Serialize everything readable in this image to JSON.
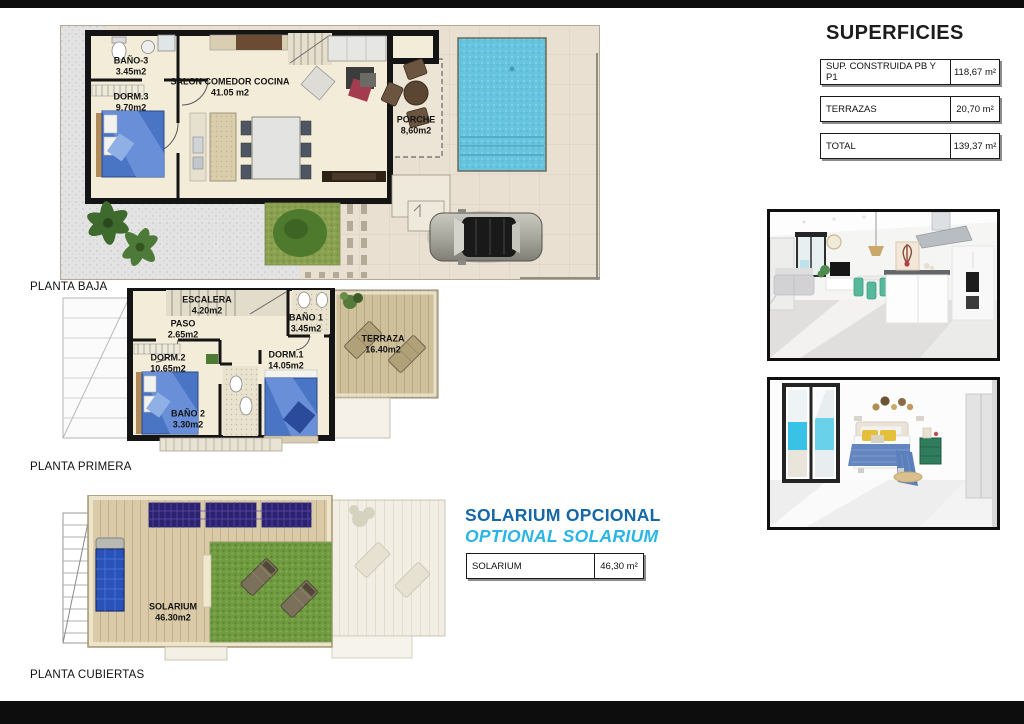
{
  "page": {
    "background": "#ffffff",
    "border_bar_color": "#0d0d0d"
  },
  "superficies": {
    "title": "SUPERFICIES",
    "rows": [
      {
        "label": "SUP. CONSTRUIDA PB Y P1",
        "value": "118,67 m²"
      },
      {
        "label": "TERRAZAS",
        "value": "20,70 m²"
      },
      {
        "label": "TOTAL",
        "value": "139,37 m²"
      }
    ]
  },
  "plans": {
    "baja": {
      "label": "PLANTA BAJA",
      "rooms": {
        "bano3": {
          "name": "BAÑO-3",
          "area": "3.45m2"
        },
        "dorm3": {
          "name": "DORM.3",
          "area": "9.70m2"
        },
        "salon": {
          "name": "SALON COMEDOR COCINA",
          "area": "41.05 m2"
        },
        "porche": {
          "name": "PORCHE",
          "area": "8,60m2"
        }
      }
    },
    "primera": {
      "label": "PLANTA PRIMERA",
      "rooms": {
        "escalera": {
          "name": "ESCALERA",
          "area": "4.20m2"
        },
        "paso": {
          "name": "PASO",
          "area": "2.65m2"
        },
        "bano1": {
          "name": "BAÑO 1",
          "area": "3.45m2"
        },
        "dorm2": {
          "name": "DORM.2",
          "area": "10.65m2"
        },
        "dorm1": {
          "name": "DORM.1",
          "area": "14.05m2"
        },
        "bano2": {
          "name": "BAÑO 2",
          "area": "3.30m2"
        },
        "terraza": {
          "name": "TERRAZA",
          "area": "16.40m2"
        }
      }
    },
    "cubiertas": {
      "label": "PLANTA CUBIERTAS",
      "rooms": {
        "solarium": {
          "name": "SOLARIUM",
          "area": "46.30m2"
        }
      }
    }
  },
  "solarium_section": {
    "title_es": "SOLARIUM OPCIONAL",
    "title_en": "OPTIONAL SOLARIUM",
    "accent_dark": "#1567a8",
    "accent_light": "#29b6e6",
    "row": {
      "label": "SOLARIUM",
      "value": "46,30 m²"
    }
  }
}
